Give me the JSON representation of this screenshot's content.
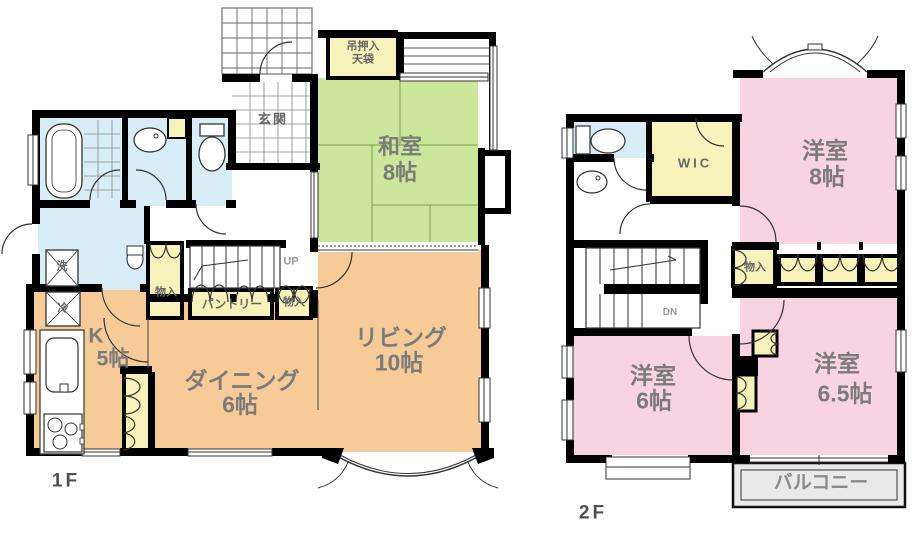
{
  "image_type": "japanese-house-floor-plan",
  "floor1": {
    "floor_label": "1F",
    "rooms": {
      "washitsu": {
        "name": "和室",
        "size": "8帖"
      },
      "living": {
        "name": "リビング",
        "size": "10帖"
      },
      "dining": {
        "name": "ダイニング",
        "size": "6帖"
      },
      "kitchen": {
        "name": "K",
        "size": "5帖"
      }
    },
    "labels": {
      "genkan": "玄関",
      "tsuri_oshiire_line1": "吊押入",
      "tsuri_oshiire_line2": "天袋",
      "pantry": "パントリー",
      "closet_a": "物入",
      "closet_b": "物入",
      "washer": "洗",
      "fridge": "冷",
      "stairs_up": "UP"
    }
  },
  "floor2": {
    "floor_label": "2F",
    "rooms": {
      "bedroom8": {
        "name": "洋室",
        "size": "8帖"
      },
      "bedroom6": {
        "name": "洋室",
        "size": "6帖"
      },
      "bedroom65": {
        "name": "洋室",
        "size": "6.5帖"
      }
    },
    "labels": {
      "wic": "WIC",
      "closet": "物入",
      "stairs_down": "DN",
      "balcony": "バルコニー"
    }
  },
  "fixtures": [
    "bathtub",
    "toilet",
    "washbasin",
    "kitchen-sink",
    "gas-stove",
    "stairs",
    "bay-window",
    "bow-window"
  ],
  "colors": {
    "tatami_room": "#cce79b",
    "ldk": "#f7cb97",
    "western_room": "#f8d3e1",
    "closet": "#f6f2ba",
    "sanitary": "#d8eef6",
    "balcony": "#e9e9e9",
    "wall": "#000000",
    "label_text": "#7b7b7b"
  }
}
